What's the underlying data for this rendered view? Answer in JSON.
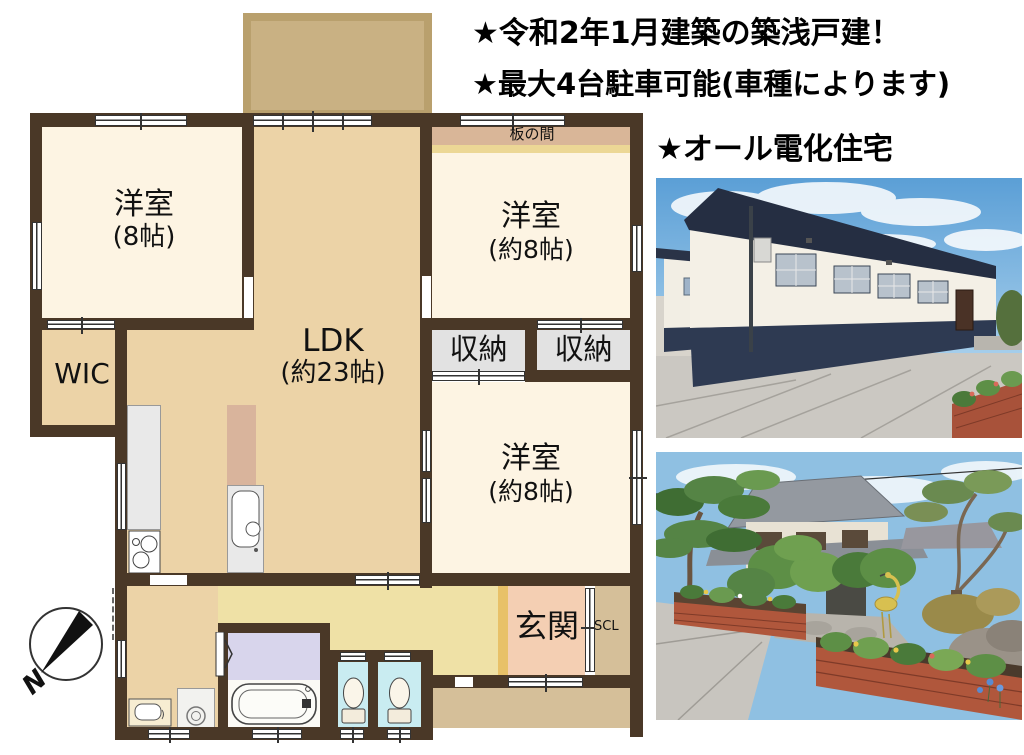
{
  "headlines": {
    "line1": "★令和2年1月建築の築浅戸建！",
    "line2": "★最大4台駐車可能(車種によります)",
    "line3": "★オール電化住宅"
  },
  "plan": {
    "rooms": {
      "bedroom_top_left": {
        "label": "洋室",
        "size": "(8帖)"
      },
      "itanoma": {
        "label": "板の間"
      },
      "bedroom_top_right": {
        "label": "洋室",
        "size": "(約8帖)"
      },
      "ldk": {
        "label": "LDK",
        "size": "(約23帖)"
      },
      "wic": {
        "label": "WIC"
      },
      "storage_left": {
        "label": "収納"
      },
      "storage_right": {
        "label": "収納"
      },
      "bedroom_middle_right": {
        "label": "洋室",
        "size": "(約8帖)"
      },
      "genkan": {
        "label": "玄関"
      },
      "shoe_closet": {
        "label": "SCL"
      }
    },
    "compass": {
      "label": "N"
    }
  },
  "colors": {
    "wall": "#4a3827",
    "room_cream": "#fdf4e3",
    "room_tan": "#ecd3a7",
    "hallway_yellow": "#efe1a6",
    "genkan_pink": "#f4cfb3",
    "step_orange": "#e8c168",
    "deck_tan": "#c9b183",
    "itanoma_band": "#d9b698",
    "closet_gray": "#e2e2e2",
    "bath_lavender": "#d8d5ec",
    "toilet_blue": "#c9ecf1",
    "porch_tan": "#d5bf99"
  }
}
